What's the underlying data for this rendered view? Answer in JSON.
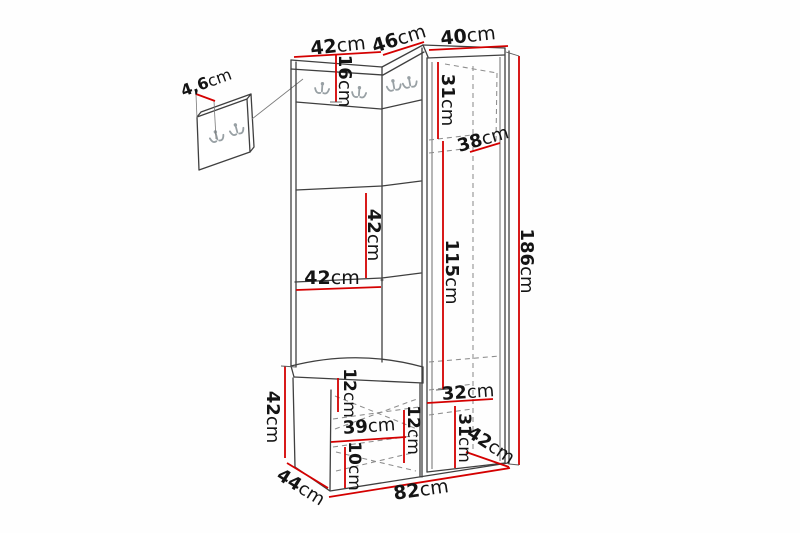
{
  "meta": {
    "description": "Dimension diagram of a corner hallway furniture set with wall hook panel, coat hooks, bench with drawers and tall cabinet",
    "background": "#fefefe"
  },
  "colors": {
    "dimension_line": "#d40000",
    "outline": "#3f3f3f",
    "hidden_line": "#8d8d8d",
    "hook": "#98a0a4",
    "label_text": "#141414"
  },
  "dims": {
    "panel_depth": {
      "value": "4,6",
      "unit": "cm"
    },
    "top_left_width": {
      "value": "42",
      "unit": "cm"
    },
    "top_corner_width": {
      "value": "46",
      "unit": "cm"
    },
    "top_right_width": {
      "value": "40",
      "unit": "cm"
    },
    "hook_rail_height": {
      "value": "16",
      "unit": "cm"
    },
    "cabinet_top_section_height": {
      "value": "31",
      "unit": "cm"
    },
    "cabinet_inner_depth": {
      "value": "38",
      "unit": "cm"
    },
    "shelf_section_height": {
      "value": "42",
      "unit": "cm"
    },
    "shelf_width": {
      "value": "42",
      "unit": "cm"
    },
    "door_section_height": {
      "value": "115",
      "unit": "cm"
    },
    "total_height": {
      "value": "186",
      "unit": "cm"
    },
    "bench_height": {
      "value": "42",
      "unit": "cm"
    },
    "bench_top_inset": {
      "value": "12",
      "unit": "cm"
    },
    "drawer_width": {
      "value": "39",
      "unit": "cm"
    },
    "bench_right_inset": {
      "value": "12",
      "unit": "cm"
    },
    "drawer_bottom_height": {
      "value": "10",
      "unit": "cm"
    },
    "cabinet_shelf_width": {
      "value": "32",
      "unit": "cm"
    },
    "cabinet_bottom_section_height": {
      "value": "31",
      "unit": "cm"
    },
    "cabinet_depth": {
      "value": "42",
      "unit": "cm"
    },
    "bench_depth": {
      "value": "44",
      "unit": "cm"
    },
    "total_width": {
      "value": "82",
      "unit": "cm"
    }
  }
}
